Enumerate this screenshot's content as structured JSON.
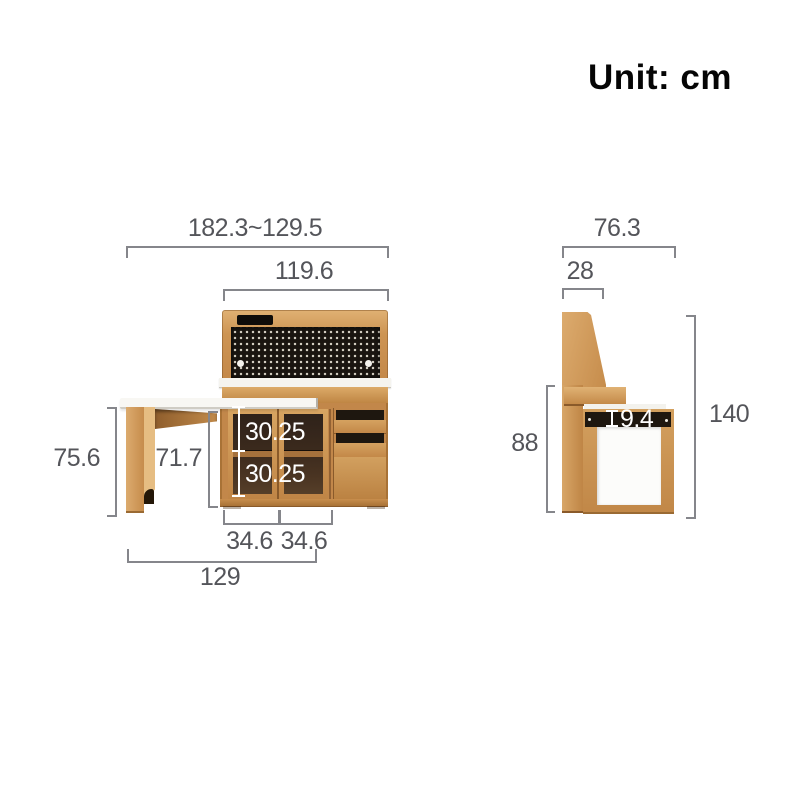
{
  "title": {
    "unit_label": "Unit: cm"
  },
  "colors": {
    "wood": "#c68c4b",
    "pegboard_panel": "#1a1510",
    "countertop": "#f5f4ef",
    "annotation_text": "#54555a",
    "annotation_line": "#85868b",
    "dimension_text_on_dark": "#ffffff"
  },
  "front_view": {
    "description": "front elevation of sideboard with fold-out table",
    "dims": {
      "total_width": "182.3~129.5",
      "hutch_width": "119.6",
      "table_height": "75.6",
      "opening_height": "71.7",
      "shelf_upper": "30.25",
      "shelf_lower": "30.25",
      "door_left_width": "34.6",
      "door_right_width": "34.6",
      "table_width": "129"
    }
  },
  "side_view": {
    "description": "side elevation of sideboard",
    "dims": {
      "total_depth": "76.3",
      "top_depth": "28",
      "counter_height": "88",
      "slot_height": "9.4",
      "total_height": "140"
    }
  }
}
